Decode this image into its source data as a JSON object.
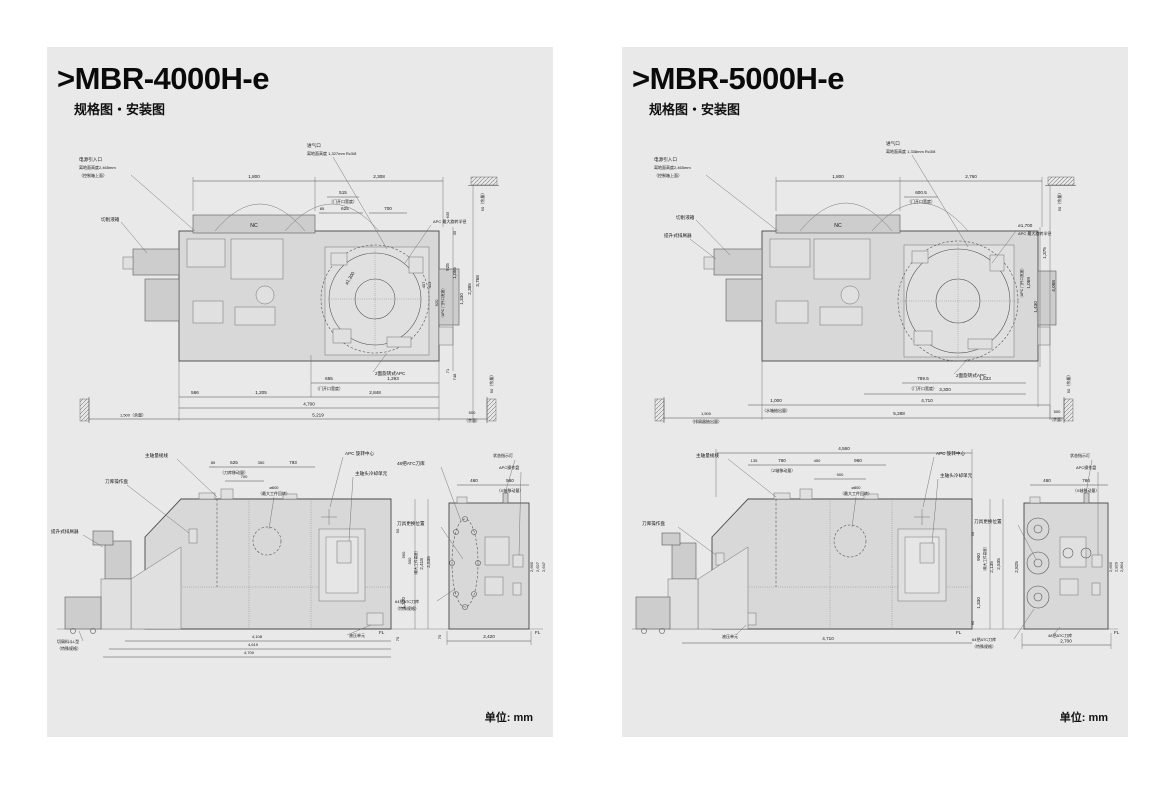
{
  "panels": [
    {
      "title": ">MBR-4000H-e",
      "subtitle": "规格图・安装图",
      "unit": "单位: mm",
      "top": {
        "labels": {
          "power": "电源引入口",
          "power2": "离地面高度2,465mm",
          "power3": "（控制箱上面）",
          "coolant": "切削液箱",
          "air": "进气口",
          "air2": "离地面高度 1,327mm Rc3/8",
          "apc_r": "APC 最大旋转半径",
          "apc_d": "⌀1,300",
          "apc2": "2面旋转式APC",
          "nc": "NC",
          "margin_t": "50（余量）",
          "margin_b": "50（余量）"
        },
        "dims": {
          "d1800": "1,800",
          "d2308": "2,308",
          "d515": "515",
          "doorw": "（门开口宽度）",
          "d85": "85",
          "d625": "625",
          "d700": "700",
          "d635": "635",
          "d35": "35",
          "d925": "925",
          "d1055": "1,055",
          "d407": "407",
          "d413": "413",
          "d920": "920",
          "apcdoor": "（APC 门开口宽度）",
          "d1330": "1,330",
          "d2385": "2,385",
          "d3768": "3,768",
          "d71": "71",
          "d748": "748",
          "d655": "655",
          "doorw2": "（门开口宽度）",
          "d1293": "1,293",
          "d566": "566",
          "d1205": "1,205",
          "d2848": "2,848",
          "d4700": "4,700",
          "d5219": "5,219",
          "m1500": "1,500（余量）",
          "d500": "500",
          "yoryo": "（余量）"
        }
      },
      "front": {
        "labels": {
          "conveyor": "提升式排屑器",
          "gauge": "主轴量规线",
          "magpanel": "刀库操作盘",
          "apcc": "APC 旋转中心",
          "cooling": "主轴头冷却单元",
          "atc48": "48把ATC刀库",
          "toolchg": "刀具更换位置",
          "atc64": "64把ATC刀库",
          "atc64b": "（特殊规格）",
          "status": "状态指示灯",
          "apcp": "APC操作盘",
          "hyd": "液压单元",
          "bucket": "切屑料斗L型",
          "bucketb": "（特殊规格）",
          "wdia": "⌀600",
          "wdiab": "（最大工件回转）"
        },
        "dims": {
          "a85": "85",
          "a625": "625",
          "a350": "350",
          "a793": "793",
          "magmv": "（刀库移动量）",
          "a700": "700",
          "h50": "50",
          "h560": "560",
          "h900": "900",
          "maxh": "（最大工件高度）",
          "h2418": "2,418",
          "h2535": "2,535",
          "h1330": "1,330",
          "h70": "70",
          "fl": "FL",
          "s460": "460",
          "s560": "560",
          "xmv": "（X轴移动量）",
          "r2665": "2,665",
          "r2627": "2,627",
          "r2647": "2,647",
          "b2420": "2,420",
          "fl2": "FL",
          "s70": "70",
          "c4108": "4,108",
          "c4619": "4,619",
          "c4700": "4,700"
        }
      }
    },
    {
      "title": ">MBR-5000H-e",
      "subtitle": "规格图・安装图",
      "unit": "单位: mm",
      "top": {
        "labels": {
          "power": "电源引入口",
          "power2": "离地面高度2,465mm",
          "power3": "（控制箱上面）",
          "coolant": "切削液箱",
          "conveyor": "提升式排屑器",
          "air": "进气口",
          "air2": "离地面高度 1,338mm Rc3/8",
          "apc_d": "⌀1,700",
          "apc_r": "APC 最大旋转半径",
          "apc2": "2面旋转式APC",
          "nc": "NC",
          "margin_t": "50（余量）",
          "margin_b": "50（余量）"
        },
        "dims": {
          "d1800": "1,800",
          "d2760": "2,760",
          "d6005": "600.5",
          "doorw": "（门开口宽度）",
          "d1375": "1,375",
          "d1069": "1,069",
          "apcdoor": "（APC 门开口宽度）",
          "d1430": "1,430",
          "d4088": "4,088",
          "d7895": "789.5",
          "doorw2": "（门开口宽度）",
          "d1633": "1,633",
          "d3300": "3,300",
          "d1000": "1,000",
          "tankout": "（水箱抽出量）",
          "d4710": "4,710",
          "d1500": "1,500",
          "convout": "（排屑器抽出量）",
          "d5288": "5,288",
          "d500": "500",
          "yoryo": "（余量）"
        }
      },
      "front": {
        "labels": {
          "gauge": "主轴量规线",
          "magpanel": "刀库操作盘",
          "apcc": "APC 旋转中心",
          "cooling": "主轴头冷却单元",
          "toolchg": "刀具更换位置",
          "status": "状态指示灯",
          "apcp": "APC操作盘",
          "atc48": "48把ATC刀库",
          "atc64": "64把ATC刀库",
          "atc64b": "（特殊规格）",
          "hyd": "液压单元",
          "wdia": "⌀800",
          "wdiab": "（最大工件回转）"
        },
        "dims": {
          "t4560": "4,560",
          "a135": "135",
          "a760": "760",
          "zmv": "（Z轴移动量）",
          "a450": "450",
          "a960": "960",
          "a900": "900",
          "h50": "50",
          "h90": "90",
          "h900": "900",
          "maxh": "（最大工件高度）",
          "h2135": "2,135",
          "h2535": "2,535",
          "h1330": "1,330",
          "fl": "FL",
          "s2825": "2,825",
          "s460": "460",
          "s760": "760",
          "xmv": "（X轴移动量）",
          "r2665": "2,665",
          "r2829": "2,829",
          "r2864": "2,864",
          "b2700": "2,700",
          "fl2": "FL",
          "c4710": "4,710"
        }
      }
    }
  ]
}
